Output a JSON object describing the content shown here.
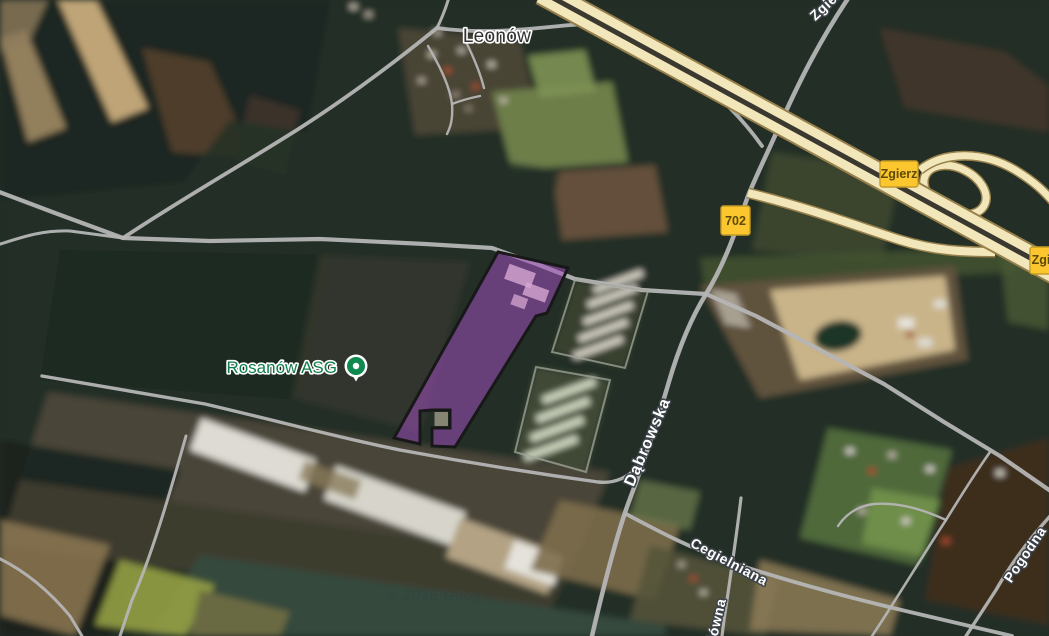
{
  "map": {
    "place_label": "Leonów",
    "poi": {
      "label": "Rosanów ASG"
    },
    "road_labels": {
      "dabrowska": "Dąbrowska",
      "cegielniana": "Cegielniana",
      "glowna": "Główna",
      "pogodna": "Pogodna",
      "zgierska": "Zgierska"
    },
    "signs": {
      "zgierz_1": "Zgierz",
      "route_702": "702",
      "zgierz_2": "Zgierz"
    },
    "attribution": "© 2026 Google",
    "colors": {
      "parcel_fill": "#A04FBE",
      "parcel_stroke": "#181818",
      "sign_bg": "#FBC62E",
      "sign_border": "#C59B25",
      "sign_text": "#5D4A05",
      "motorway_yellow": "#F2E7BB",
      "road_gray": "#B5B5B5",
      "poi_green": "#0F8A4F",
      "poi_text_green": "#0E7D4A",
      "place_text": "#323232",
      "road_label_text": "#FFFFFF"
    }
  }
}
